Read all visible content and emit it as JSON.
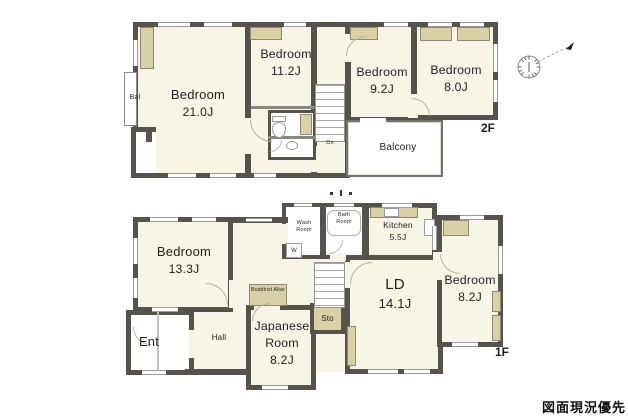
{
  "colors": {
    "wall": "#56524c",
    "room_fill": "#f8f4e6",
    "closet_fill": "#d9d0a6"
  },
  "footer": {
    "note": "図面現況優先"
  },
  "compass": {
    "description": "north-arrow-compass"
  },
  "floor2": {
    "floor_label": "2F",
    "bedroom_21": {
      "name": "Bedroom",
      "size": "21.0J"
    },
    "bedroom_11": {
      "name": "Bedroom",
      "size": "11.2J"
    },
    "bedroom_9": {
      "name": "Bedroom",
      "size": "9.2J"
    },
    "bedroom_8": {
      "name": "Bedroom",
      "size": "8.0J"
    },
    "balcony": {
      "name": "Balcony"
    },
    "bal": {
      "name": "Bal"
    },
    "stairs": {
      "label": "Dn"
    }
  },
  "floor1": {
    "floor_label": "1F",
    "bedroom_13": {
      "name": "Bedroom",
      "size": "13.3J"
    },
    "entrance": {
      "name": "Ent"
    },
    "hall": {
      "name": "Hall"
    },
    "japanese_room": {
      "name": "Japanese Room",
      "size": "8.2J"
    },
    "buddhist_altar": {
      "name": "Buddhist Altar"
    },
    "wash_room": {
      "name": "Wash Room"
    },
    "washer": {
      "name": "W"
    },
    "bath_room": {
      "name": "Bath Room"
    },
    "kitchen": {
      "name": "Kitchen",
      "size": "5.5J"
    },
    "living_dining": {
      "name": "LD",
      "size": "14.1J"
    },
    "storage": {
      "name": "Sto"
    },
    "bedroom_8": {
      "name": "Bedroom",
      "size": "8.2J"
    }
  }
}
